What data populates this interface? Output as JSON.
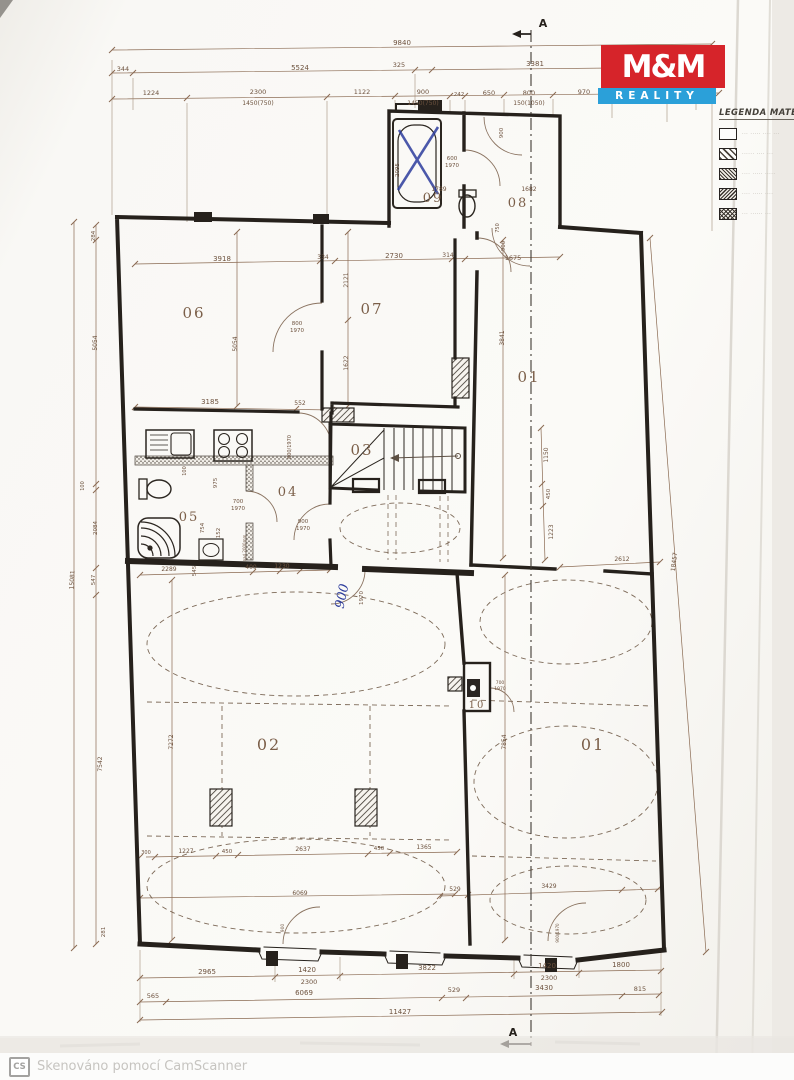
{
  "logo": {
    "line1": "M&M",
    "line2": "REALITY",
    "red": "#d6242a",
    "blue": "#2ba0d9"
  },
  "legend": {
    "title": "LEGENDA MATE",
    "items": [
      {
        "swatch": "solid",
        "label": "··· ····· ···· ···"
      },
      {
        "swatch": "hatch1",
        "label": "······ ···· ···"
      },
      {
        "swatch": "hatch2",
        "label": "···· ····· ·····"
      },
      {
        "swatch": "hatch3",
        "label": "···· ····· ····"
      },
      {
        "swatch": "dots",
        "label": "··· ······ ···"
      }
    ]
  },
  "watermark": {
    "badge": "CS",
    "text": "Skenováno pomocí CamScanner"
  },
  "annotations": {
    "handwritten_value": "900",
    "ink_color": "#2c3c9c",
    "crossed_out_fixture": "bathtub"
  },
  "plan_labels": [
    {
      "t": "9840",
      "x": 402,
      "y": 45
    },
    {
      "t": "344",
      "x": 123,
      "y": 71,
      "s": 6.5
    },
    {
      "t": "5524",
      "x": 300,
      "y": 70
    },
    {
      "t": "325",
      "x": 399,
      "y": 67,
      "s": 6.5
    },
    {
      "t": "3381",
      "x": 535,
      "y": 66
    },
    {
      "t": "266",
      "x": 704,
      "y": 70,
      "s": 6.5
    },
    {
      "t": "1224",
      "x": 151,
      "y": 95,
      "s": 6.5
    },
    {
      "t": "2300",
      "x": 258,
      "y": 94,
      "s": 6.5
    },
    {
      "t": "1450(750)",
      "x": 258,
      "y": 105,
      "s": 6
    },
    {
      "t": "1122",
      "x": 362,
      "y": 94,
      "s": 6.5
    },
    {
      "t": "900",
      "x": 423,
      "y": 94,
      "s": 6.5
    },
    {
      "t": "1450(750)",
      "x": 423,
      "y": 105,
      "s": 6
    },
    {
      "t": "242",
      "x": 459,
      "y": 96,
      "s": 5.5
    },
    {
      "t": "650",
      "x": 489,
      "y": 95,
      "s": 6.5
    },
    {
      "t": "800",
      "x": 529,
      "y": 95,
      "s": 6.5
    },
    {
      "t": "150(1050)",
      "x": 529,
      "y": 105,
      "s": 6
    },
    {
      "t": "970",
      "x": 584,
      "y": 94,
      "s": 6.5
    },
    {
      "t": "900",
      "x": 639,
      "y": 94,
      "s": 6.5
    },
    {
      "t": "2050",
      "x": 639,
      "y": 104,
      "s": 6
    },
    {
      "t": "851",
      "x": 694,
      "y": 96,
      "s": 6.5
    },
    {
      "t": "A",
      "x": 543,
      "y": 27,
      "s": 11,
      "c": "sec"
    },
    {
      "t": "A",
      "x": 513,
      "y": 1036,
      "s": 11,
      "c": "sec"
    },
    {
      "t": "2095",
      "x": 399,
      "y": 170,
      "r": -90,
      "s": 5.5
    },
    {
      "t": "09",
      "x": 433,
      "y": 202,
      "s": 13,
      "c": "room"
    },
    {
      "t": "600",
      "x": 452,
      "y": 160,
      "s": 5.5
    },
    {
      "t": "1970",
      "x": 452,
      "y": 167,
      "s": 5.5
    },
    {
      "t": "1789",
      "x": 439,
      "y": 191,
      "s": 6
    },
    {
      "t": "900",
      "x": 503,
      "y": 133,
      "r": -90,
      "s": 5.5
    },
    {
      "t": "08",
      "x": 518,
      "y": 207,
      "s": 13,
      "c": "room"
    },
    {
      "t": "1682",
      "x": 529,
      "y": 191,
      "s": 6
    },
    {
      "t": "750",
      "x": 499,
      "y": 228,
      "r": -90,
      "s": 5
    },
    {
      "t": "900",
      "x": 505,
      "y": 246,
      "r": -90,
      "s": 5.5
    },
    {
      "t": "1675",
      "x": 513,
      "y": 260,
      "s": 6.5
    },
    {
      "t": "3918",
      "x": 222,
      "y": 261
    },
    {
      "t": "334",
      "x": 323,
      "y": 259,
      "s": 6
    },
    {
      "t": "2730",
      "x": 394,
      "y": 258,
      "s": 7
    },
    {
      "t": "314",
      "x": 448,
      "y": 257,
      "s": 6
    },
    {
      "t": "2121",
      "x": 348,
      "y": 280,
      "r": -90,
      "s": 6
    },
    {
      "t": "1622",
      "x": 348,
      "y": 363,
      "r": -90,
      "s": 6
    },
    {
      "t": "5054",
      "x": 237,
      "y": 344,
      "r": -90,
      "s": 6
    },
    {
      "t": "06",
      "x": 194,
      "y": 318,
      "s": 15,
      "c": "room"
    },
    {
      "t": "07",
      "x": 372,
      "y": 314,
      "s": 15,
      "c": "room"
    },
    {
      "t": "01",
      "x": 529,
      "y": 382,
      "s": 15,
      "c": "room"
    },
    {
      "t": "3841",
      "x": 504,
      "y": 338,
      "r": -90,
      "s": 6
    },
    {
      "t": "800",
      "x": 297,
      "y": 325,
      "s": 5.5
    },
    {
      "t": "1970",
      "x": 297,
      "y": 332,
      "s": 5.5
    },
    {
      "t": "3185",
      "x": 210,
      "y": 404
    },
    {
      "t": "552",
      "x": 300,
      "y": 405,
      "s": 6
    },
    {
      "t": "100",
      "x": 186,
      "y": 471,
      "r": -90,
      "s": 5
    },
    {
      "t": "975",
      "x": 217,
      "y": 483,
      "r": -90,
      "s": 5.5
    },
    {
      "t": "04",
      "x": 288,
      "y": 496,
      "s": 13,
      "c": "room"
    },
    {
      "t": "800/1970",
      "x": 291,
      "y": 447,
      "r": -90,
      "s": 5
    },
    {
      "t": "700",
      "x": 238,
      "y": 503,
      "s": 5.5
    },
    {
      "t": "1970",
      "x": 238,
      "y": 510,
      "s": 5.5
    },
    {
      "t": "05",
      "x": 189,
      "y": 521,
      "s": 13,
      "c": "room"
    },
    {
      "t": "754",
      "x": 204,
      "y": 528,
      "r": -90,
      "s": 5.5
    },
    {
      "t": "152",
      "x": 220,
      "y": 533,
      "r": -90,
      "s": 5.5
    },
    {
      "t": "nad 2000mm",
      "x": 246,
      "y": 548,
      "r": -90,
      "s": 4
    },
    {
      "t": "900",
      "x": 303,
      "y": 523,
      "s": 5.5
    },
    {
      "t": "1970",
      "x": 303,
      "y": 530,
      "s": 5.5
    },
    {
      "t": "2289",
      "x": 169,
      "y": 571,
      "s": 6
    },
    {
      "t": "545",
      "x": 196,
      "y": 571,
      "r": -90,
      "s": 5.5
    },
    {
      "t": "400",
      "x": 251,
      "y": 569,
      "s": 6
    },
    {
      "t": "1230",
      "x": 282,
      "y": 568,
      "s": 6
    },
    {
      "t": "03",
      "x": 362,
      "y": 455,
      "s": 15,
      "c": "room"
    },
    {
      "t": "1150",
      "x": 548,
      "y": 455,
      "r": -90,
      "s": 6
    },
    {
      "t": "450",
      "x": 550,
      "y": 494,
      "r": -90,
      "s": 5.5
    },
    {
      "t": "1223",
      "x": 553,
      "y": 532,
      "r": -90,
      "s": 6
    },
    {
      "t": "2612",
      "x": 622,
      "y": 561,
      "s": 6
    },
    {
      "t": "900",
      "x": 346,
      "y": 597,
      "r": -78,
      "s": 13,
      "c": "hand"
    },
    {
      "t": "1970",
      "x": 363,
      "y": 598,
      "r": -90,
      "s": 5.5
    },
    {
      "t": "02",
      "x": 269,
      "y": 750,
      "s": 16,
      "c": "room"
    },
    {
      "t": "7272",
      "x": 173,
      "y": 742,
      "r": -90,
      "s": 6
    },
    {
      "t": "01",
      "x": 593,
      "y": 750,
      "s": 16,
      "c": "room"
    },
    {
      "t": "7854",
      "x": 506,
      "y": 742,
      "r": -90,
      "s": 6
    },
    {
      "t": "10",
      "x": 477,
      "y": 708,
      "s": 10,
      "c": "room"
    },
    {
      "t": "700",
      "x": 500,
      "y": 684,
      "s": 4.5
    },
    {
      "t": "1970",
      "x": 500,
      "y": 690,
      "s": 4.5
    },
    {
      "t": "300",
      "x": 146,
      "y": 854,
      "s": 5
    },
    {
      "t": "1227",
      "x": 186,
      "y": 853,
      "s": 6
    },
    {
      "t": "450",
      "x": 227,
      "y": 853,
      "s": 5.5
    },
    {
      "t": "2637",
      "x": 303,
      "y": 851,
      "s": 6
    },
    {
      "t": "450",
      "x": 379,
      "y": 850,
      "s": 5.5
    },
    {
      "t": "1365",
      "x": 424,
      "y": 849,
      "s": 6
    },
    {
      "t": "6069",
      "x": 300,
      "y": 895,
      "s": 6
    },
    {
      "t": "900",
      "x": 284,
      "y": 928,
      "r": -90,
      "s": 4.5
    },
    {
      "t": "529",
      "x": 455,
      "y": 891,
      "s": 6
    },
    {
      "t": "3429",
      "x": 549,
      "y": 888,
      "s": 6
    },
    {
      "t": "900/1970",
      "x": 559,
      "y": 933,
      "r": -90,
      "s": 4
    },
    {
      "t": "2965",
      "x": 207,
      "y": 974
    },
    {
      "t": "1420",
      "x": 307,
      "y": 972
    },
    {
      "t": "2300",
      "x": 309,
      "y": 984,
      "s": 6.5
    },
    {
      "t": "3822",
      "x": 427,
      "y": 970
    },
    {
      "t": "1420",
      "x": 547,
      "y": 968
    },
    {
      "t": "2300",
      "x": 549,
      "y": 980,
      "s": 6.5
    },
    {
      "t": "1800",
      "x": 621,
      "y": 967
    },
    {
      "t": "565",
      "x": 153,
      "y": 998,
      "s": 6.5
    },
    {
      "t": "6069",
      "x": 304,
      "y": 995
    },
    {
      "t": "529",
      "x": 454,
      "y": 992,
      "s": 6.5
    },
    {
      "t": "3430",
      "x": 544,
      "y": 990
    },
    {
      "t": "815",
      "x": 640,
      "y": 991,
      "s": 6.5
    },
    {
      "t": "11427",
      "x": 400,
      "y": 1014
    },
    {
      "t": "284",
      "x": 95,
      "y": 236,
      "r": -90,
      "s": 5.5
    },
    {
      "t": "5054",
      "x": 97,
      "y": 343,
      "r": -90,
      "s": 6
    },
    {
      "t": "100",
      "x": 84,
      "y": 486,
      "r": -90,
      "s": 5
    },
    {
      "t": "2084",
      "x": 97,
      "y": 528,
      "r": -90,
      "s": 5.5
    },
    {
      "t": "547",
      "x": 95,
      "y": 580,
      "r": -90,
      "s": 5.5
    },
    {
      "t": "15081",
      "x": 74,
      "y": 580,
      "r": -87,
      "s": 6
    },
    {
      "t": "7542",
      "x": 102,
      "y": 764,
      "r": -90,
      "s": 6
    },
    {
      "t": "281",
      "x": 105,
      "y": 932,
      "r": -90,
      "s": 5.5
    },
    {
      "t": "18457",
      "x": 676,
      "y": 562,
      "r": -83,
      "s": 6
    }
  ]
}
